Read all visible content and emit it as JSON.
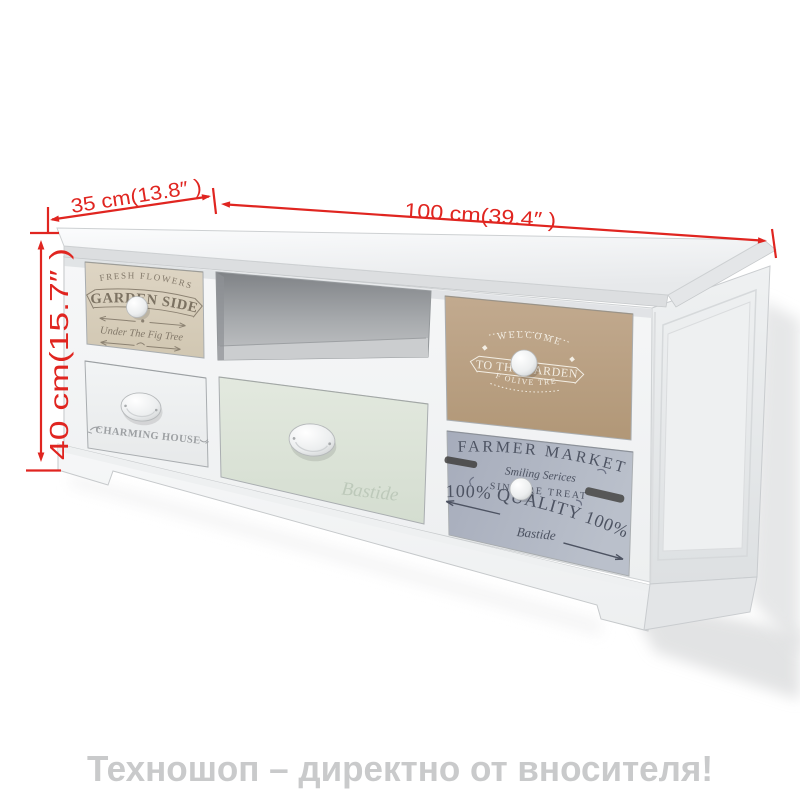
{
  "dimensions": {
    "depth": "35 cm(13.8″ )",
    "width": "100 cm(39.4″ )",
    "height": "40 cm(15.7″ )"
  },
  "caption": "Техношоп – директно от вносителя!",
  "colors": {
    "dimension_red": "#e02520",
    "caption_gray": "#c9cacb",
    "drawer_cream": "#d8cfbc",
    "drawer_tan": "#bba27f",
    "drawer_mint": "#dde4d8",
    "drawer_grayblue": "#aab0bf",
    "cabinet_white": "#f4f5f6"
  },
  "drawers": {
    "fresh_flowers": {
      "arc_text": "FRESH FLOWERS",
      "main_text": "GARDEN SIDE",
      "script_text": "Under The Fig Tree"
    },
    "charming_house": {
      "label": "CHARMING HOUSE"
    },
    "bastide": {
      "label": "Bastide"
    },
    "welcome_garden": {
      "arc_text": "WELCOME",
      "banner_text": "TO THE GARDEN",
      "bottom_text": "OF OLIVE TREE"
    },
    "farmer_market": {
      "title": "FARMER MARKET",
      "script1": "Smiling Serices",
      "line3": "SINCERE TREAT",
      "quality": "100% QUALITY 100%",
      "script2": "Bastide"
    }
  }
}
